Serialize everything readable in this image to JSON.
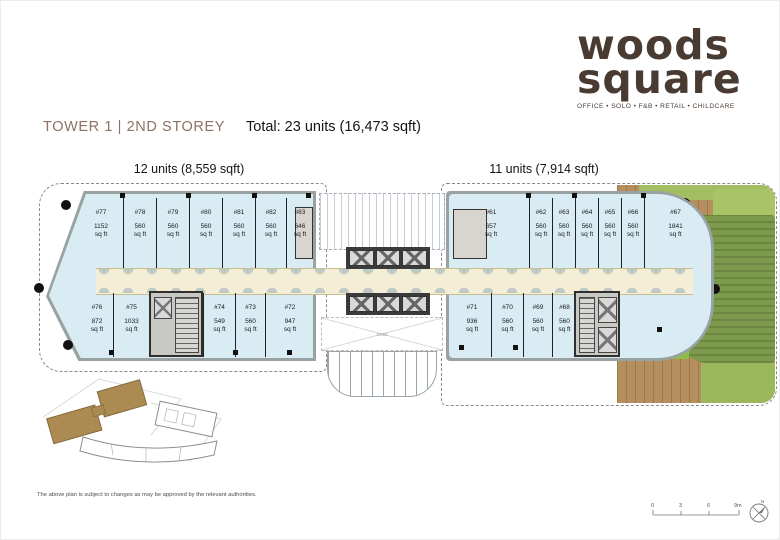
{
  "logo": {
    "line1": "woods",
    "line2": "square",
    "tagline": "OFFICE • SOLO • F&B • RETAIL • CHILDCARE"
  },
  "header": {
    "title": "TOWER  1 | 2ND STOREY",
    "total": "Total: 23 units (16,473 sqft)"
  },
  "wings": {
    "left_label": "12 units (8,559 sqft)",
    "right_label": "11 units (7,914 sqft)"
  },
  "labels": {
    "sqft": "sq ft",
    "void": "VOID"
  },
  "units": {
    "left_top": [
      {
        "id": "#77",
        "area": "1152"
      },
      {
        "id": "#78",
        "area": "560"
      },
      {
        "id": "#79",
        "area": "560"
      },
      {
        "id": "#80",
        "area": "560"
      },
      {
        "id": "#81",
        "area": "560"
      },
      {
        "id": "#82",
        "area": "560"
      },
      {
        "id": "#83",
        "area": "646"
      }
    ],
    "left_bottom": [
      {
        "id": "#76",
        "area": "872"
      },
      {
        "id": "#75",
        "area": "1033"
      },
      {
        "id": "#74",
        "area": "549"
      },
      {
        "id": "#73",
        "area": "560"
      },
      {
        "id": "#72",
        "area": "947"
      }
    ],
    "right_top": [
      {
        "id": "#61",
        "area": "657"
      },
      {
        "id": "#62",
        "area": "560"
      },
      {
        "id": "#63",
        "area": "560"
      },
      {
        "id": "#64",
        "area": "560"
      },
      {
        "id": "#65",
        "area": "560"
      },
      {
        "id": "#66",
        "area": "560"
      },
      {
        "id": "#67",
        "area": "1841"
      }
    ],
    "right_bottom": [
      {
        "id": "#71",
        "area": "936"
      },
      {
        "id": "#70",
        "area": "560"
      },
      {
        "id": "#69",
        "area": "560"
      },
      {
        "id": "#68",
        "area": "560"
      }
    ]
  },
  "scale": {
    "ticks": [
      "0",
      "3",
      "6",
      "9m"
    ],
    "north": "N"
  },
  "footer": {
    "disclaimer": "The above plan is subject to changes as may be approved by the relevant authorities."
  },
  "colors": {
    "brand_brown": "#4a3b32",
    "title_brown": "#8d7263",
    "unit_fill": "#d9ecf4",
    "corridor": "#f5eed6",
    "landscape_green": "#7c9a4b",
    "deck": "#b5905e"
  }
}
